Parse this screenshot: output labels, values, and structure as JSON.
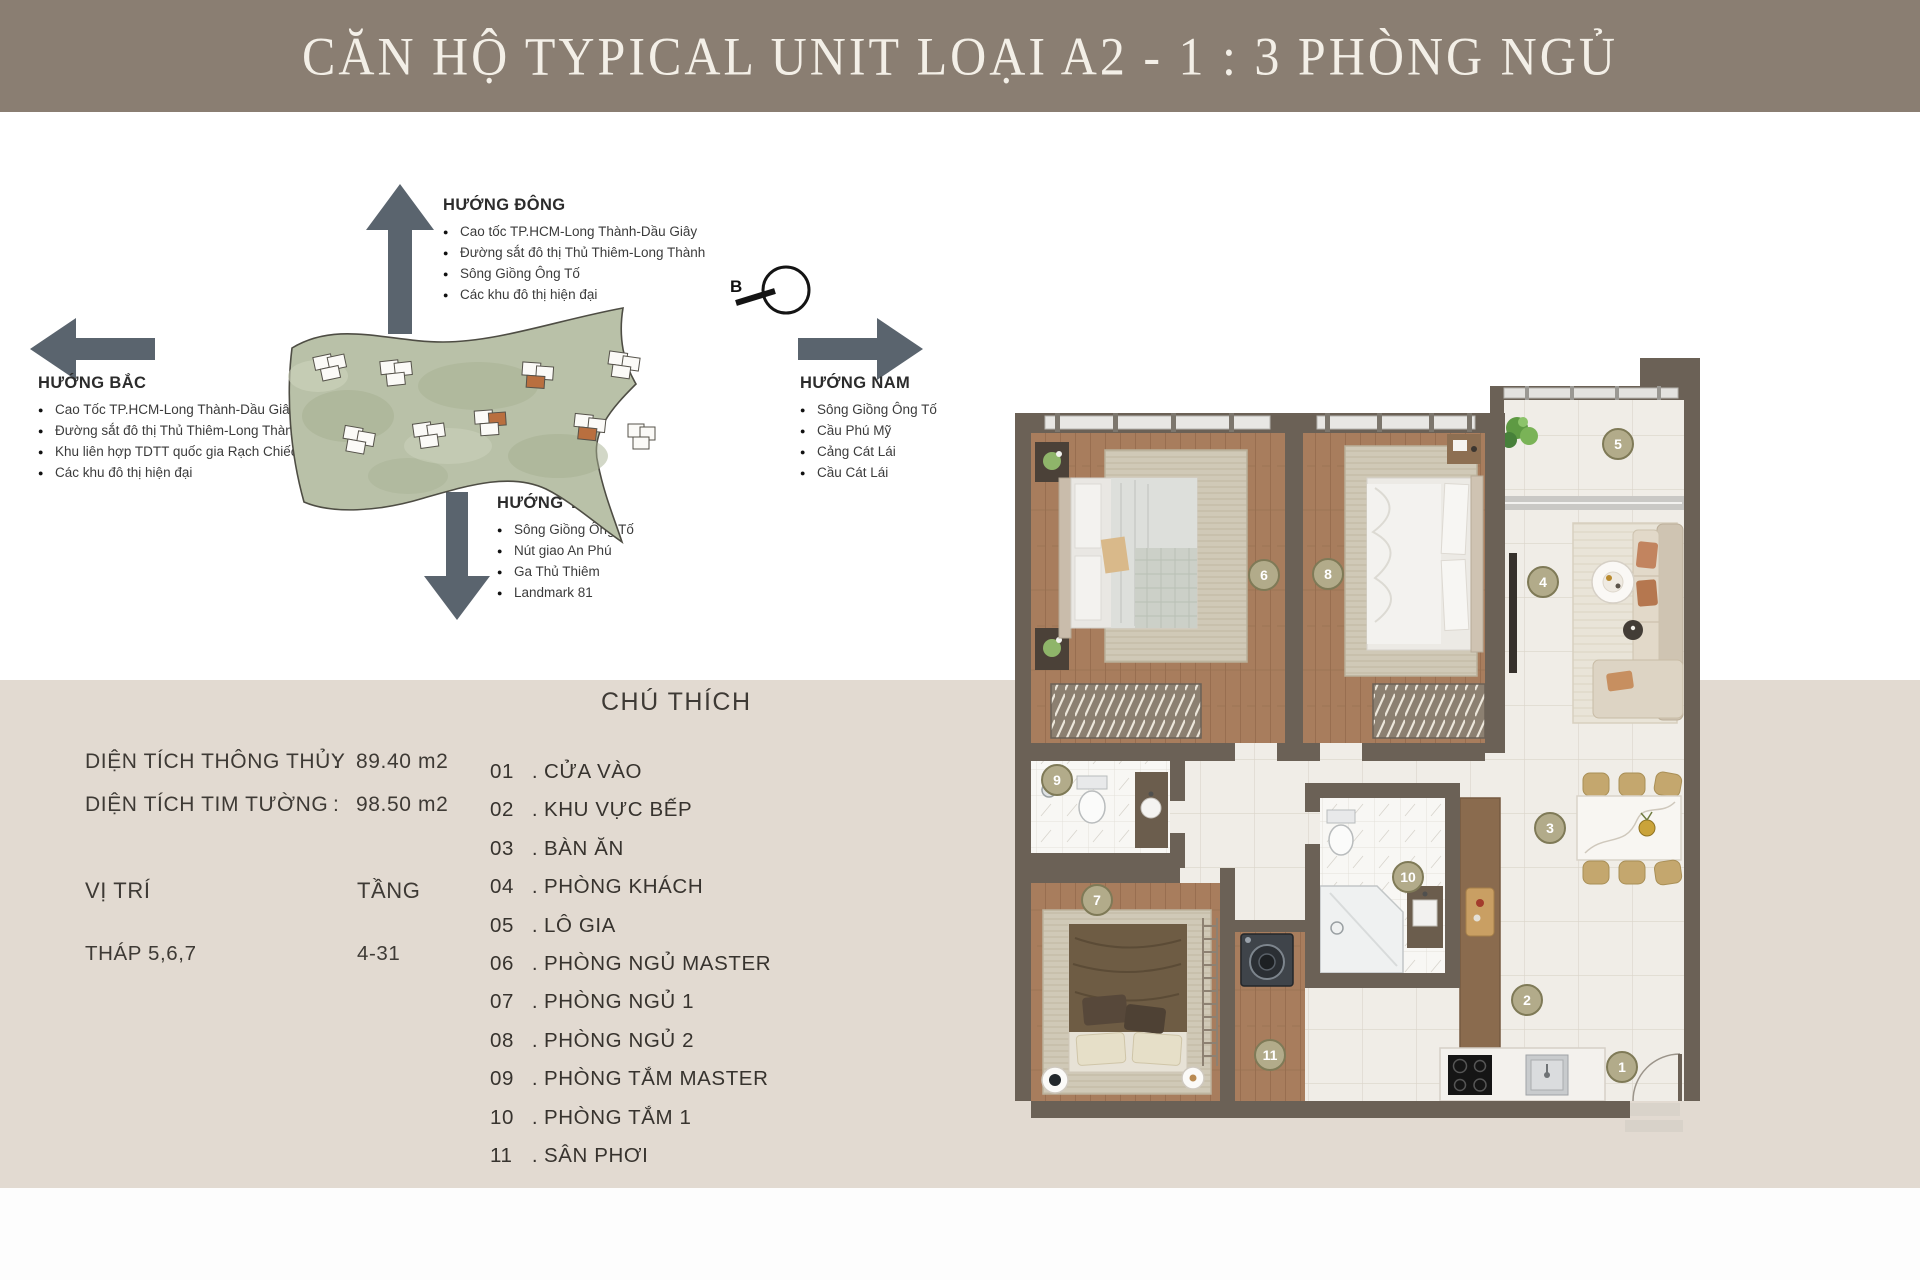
{
  "header": {
    "title": "CĂN HỘ TYPICAL UNIT LOẠI A2 - 1 : 3 PHÒNG NGỦ"
  },
  "directions": {
    "east": {
      "title": "HƯỚNG ĐÔNG",
      "items": [
        "Cao tốc TP.HCM-Long Thành-Dầu Giây",
        "Đường sắt đô thị Thủ Thiêm-Long Thành",
        "Sông Giồng Ông Tố",
        "Các khu đô thị hiện đại"
      ]
    },
    "north": {
      "title": "HƯỚNG BẮC",
      "items": [
        "Cao Tốc TP.HCM-Long Thành-Dầu Giây",
        "Đường sắt đô thị Thủ Thiêm-Long Thành",
        "Khu liên hợp TDTT quốc gia Rạch Chiếc",
        "Các khu đô thị hiện đại"
      ]
    },
    "south": {
      "title": "HƯỚNG NAM",
      "items": [
        "Sông Giồng Ông Tố",
        "Cầu Phú Mỹ",
        "Cảng Cát Lái",
        "Cầu Cát Lái"
      ]
    },
    "west": {
      "title": "HƯỚNG TÂY",
      "items": [
        "Sông Giồng Ông Tố",
        "Nút giao An Phú",
        "Ga Thủ Thiêm",
        "Landmark 81"
      ]
    }
  },
  "compass": {
    "label": "B"
  },
  "info": {
    "rows": [
      {
        "label": "DIỆN TÍCH THÔNG THỦY",
        "sep": ":",
        "value": "89.40 m2"
      },
      {
        "label": "DIỆN TÍCH TIM TƯỜNG",
        "sep": ":",
        "value": "98.50 m2"
      }
    ],
    "position_label": "VỊ TRÍ",
    "floor_label": "TẦNG",
    "position_value": "THÁP 5,6,7",
    "floor_value": "4-31"
  },
  "legend": {
    "title": "CHÚ THÍCH",
    "separator": ".",
    "items": [
      {
        "num": "01",
        "label": "CỬA VÀO"
      },
      {
        "num": "02",
        "label": "KHU VỰC BẾP"
      },
      {
        "num": "03",
        "label": "BÀN ĂN"
      },
      {
        "num": "04",
        "label": "PHÒNG KHÁCH"
      },
      {
        "num": "05",
        "label": "LÔ GIA"
      },
      {
        "num": "06",
        "label": "PHÒNG NGỦ MASTER"
      },
      {
        "num": "07",
        "label": "PHÒNG NGỦ 1"
      },
      {
        "num": "08",
        "label": "PHÒNG NGỦ 2"
      },
      {
        "num": "09",
        "label": "PHÒNG TẮM MASTER"
      },
      {
        "num": "10",
        "label": "PHÒNG TẮM 1"
      },
      {
        "num": "11",
        "label": "SÂN PHƠI"
      }
    ]
  },
  "floorplan": {
    "badges": [
      "1",
      "2",
      "3",
      "4",
      "5",
      "6",
      "7",
      "8",
      "9",
      "10",
      "11"
    ]
  },
  "colors": {
    "header_bg": "#8a7e72",
    "panel_bg": "#e2dad1",
    "arrow": "#5a646e",
    "badge_fill": "#b2ab8a",
    "badge_ring": "#7f7a57",
    "wall": "#6b6156",
    "wood": "#a87d5d",
    "tile": "#f0ede7",
    "site_green": "#b9c1a8",
    "tower_highlight": "#b96f3f"
  }
}
